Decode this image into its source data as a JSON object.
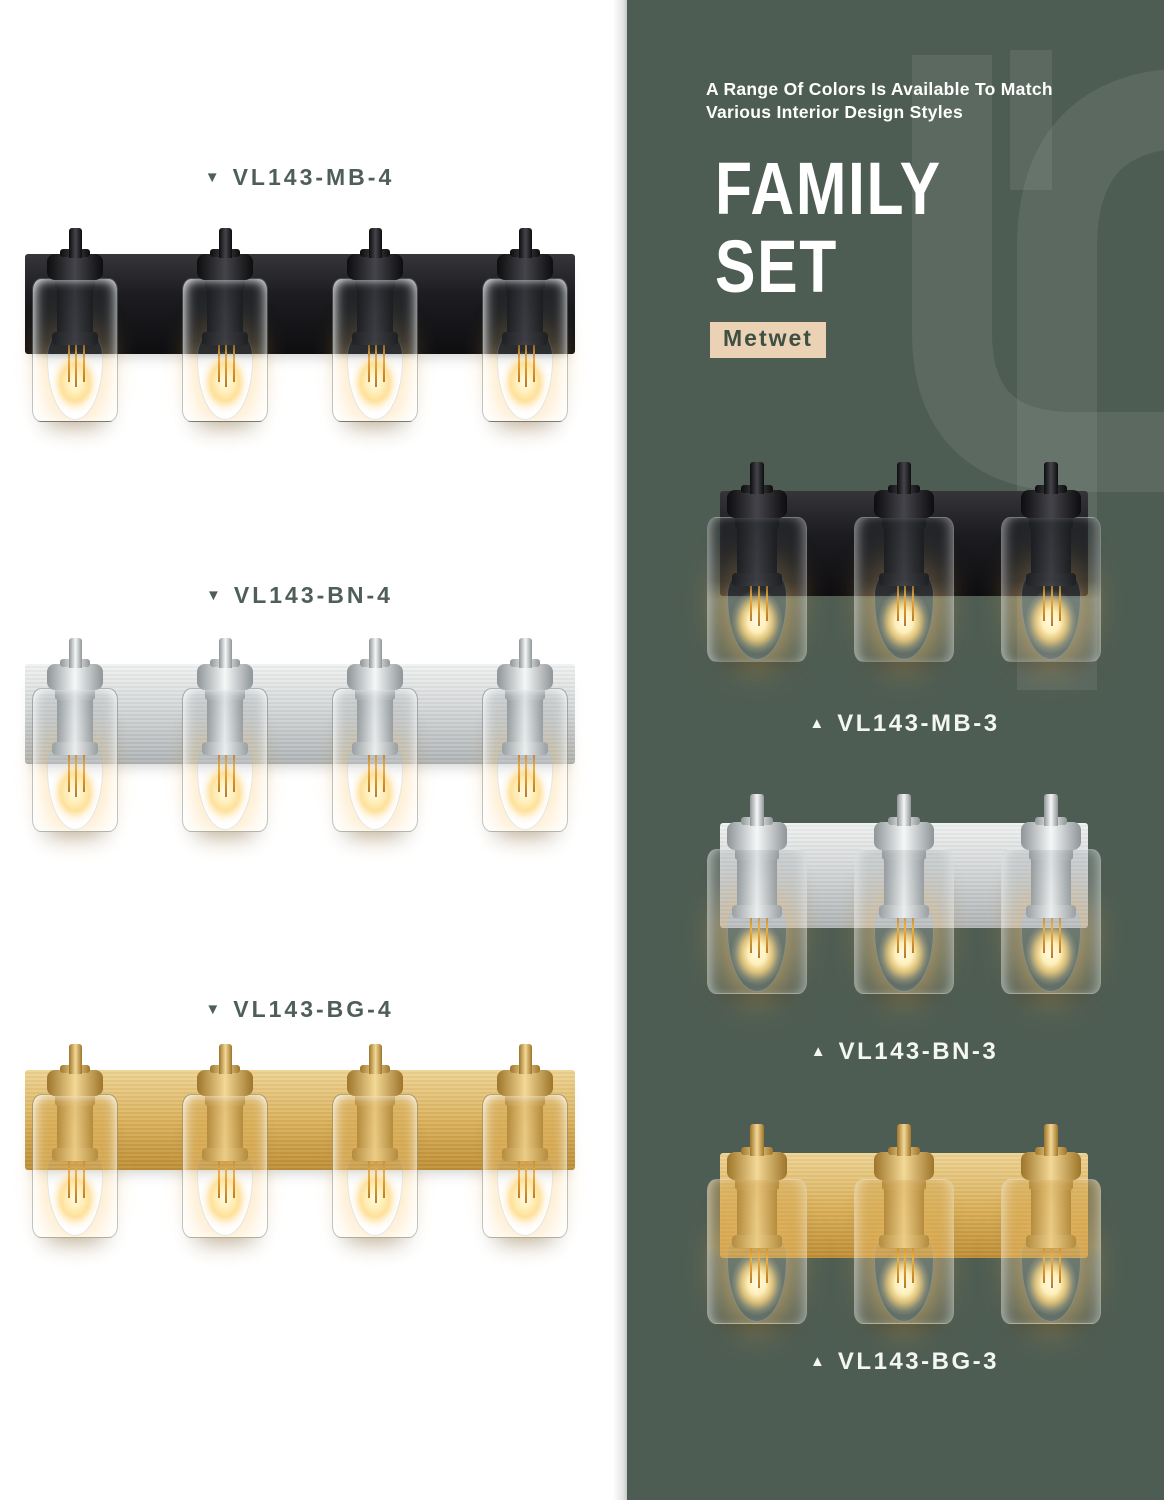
{
  "page": {
    "background": "#ffffff"
  },
  "panel": {
    "background": "#4e5d53",
    "watermark_color": "#ffffff",
    "watermark_opacity": 0.08,
    "tagline_line1": "A Range Of Colors Is Available To Match",
    "tagline_line2": "Various Interior Design Styles",
    "title_line1": "FAMILY",
    "title_line2": "SET",
    "badge_label": "Metwet",
    "badge_bg": "#ecd2b4",
    "badge_text": "#3e4f44",
    "label_color": "#f3f6f2"
  },
  "left_label_color": "#4f5f58",
  "fixtures": [
    {
      "label": "VL143-MB-4",
      "arrow": "▼",
      "finish": "black",
      "lights": 4,
      "background": "white"
    },
    {
      "label": "VL143-BN-4",
      "arrow": "▼",
      "finish": "nickel",
      "lights": 4,
      "background": "white"
    },
    {
      "label": "VL143-BG-4",
      "arrow": "▼",
      "finish": "brass",
      "lights": 4,
      "background": "white"
    },
    {
      "label": "VL143-MB-3",
      "arrow": "▲",
      "finish": "black",
      "lights": 3,
      "background": "green"
    },
    {
      "label": "VL143-BN-3",
      "arrow": "▲",
      "finish": "nickel",
      "lights": 3,
      "background": "green"
    },
    {
      "label": "VL143-BG-3",
      "arrow": "▲",
      "finish": "brass",
      "lights": 3,
      "background": "green"
    }
  ],
  "finishes": {
    "black": {
      "base": "#1c1c1f",
      "light": "#44444a",
      "dark": "#0d0d0f"
    },
    "nickel": {
      "base": "#cfd3d5",
      "light": "#f5f7f7",
      "dark": "#8f9598"
    },
    "brass": {
      "base": "#d9ae56",
      "light": "#f3d896",
      "dark": "#9e752a"
    }
  },
  "bulb": {
    "glow": "#ffd98a",
    "filament": "#e8a62e"
  }
}
